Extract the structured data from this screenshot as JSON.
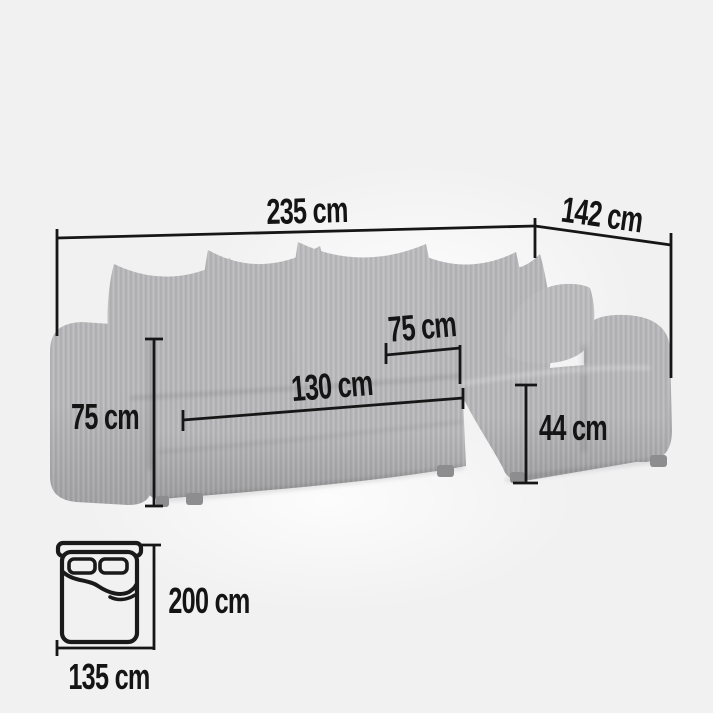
{
  "diagram": {
    "title_hint": "corner sofa dimension diagram",
    "colors": {
      "background": "#f1f1f2",
      "ink": "#161616",
      "sofa_fabric": "#b8b8ba",
      "sofa_fabric_shade": "#acacae",
      "sofa_feet": "#8d8d8f"
    },
    "measurements": {
      "overall_width": {
        "label": "235 cm"
      },
      "overall_depth": {
        "label": "142 cm"
      },
      "seat_depth": {
        "label": "75 cm"
      },
      "seat_width": {
        "label": "130 cm"
      },
      "overall_height": {
        "label": "75 cm"
      },
      "seat_height": {
        "label": "44 cm"
      },
      "sleeping_length": {
        "label": "200 cm"
      },
      "sleeping_width": {
        "label": "135 cm"
      }
    },
    "icons": [
      {
        "name": "corner-sofa-illustration"
      },
      {
        "name": "sleeping-area-bed-icon"
      }
    ]
  }
}
